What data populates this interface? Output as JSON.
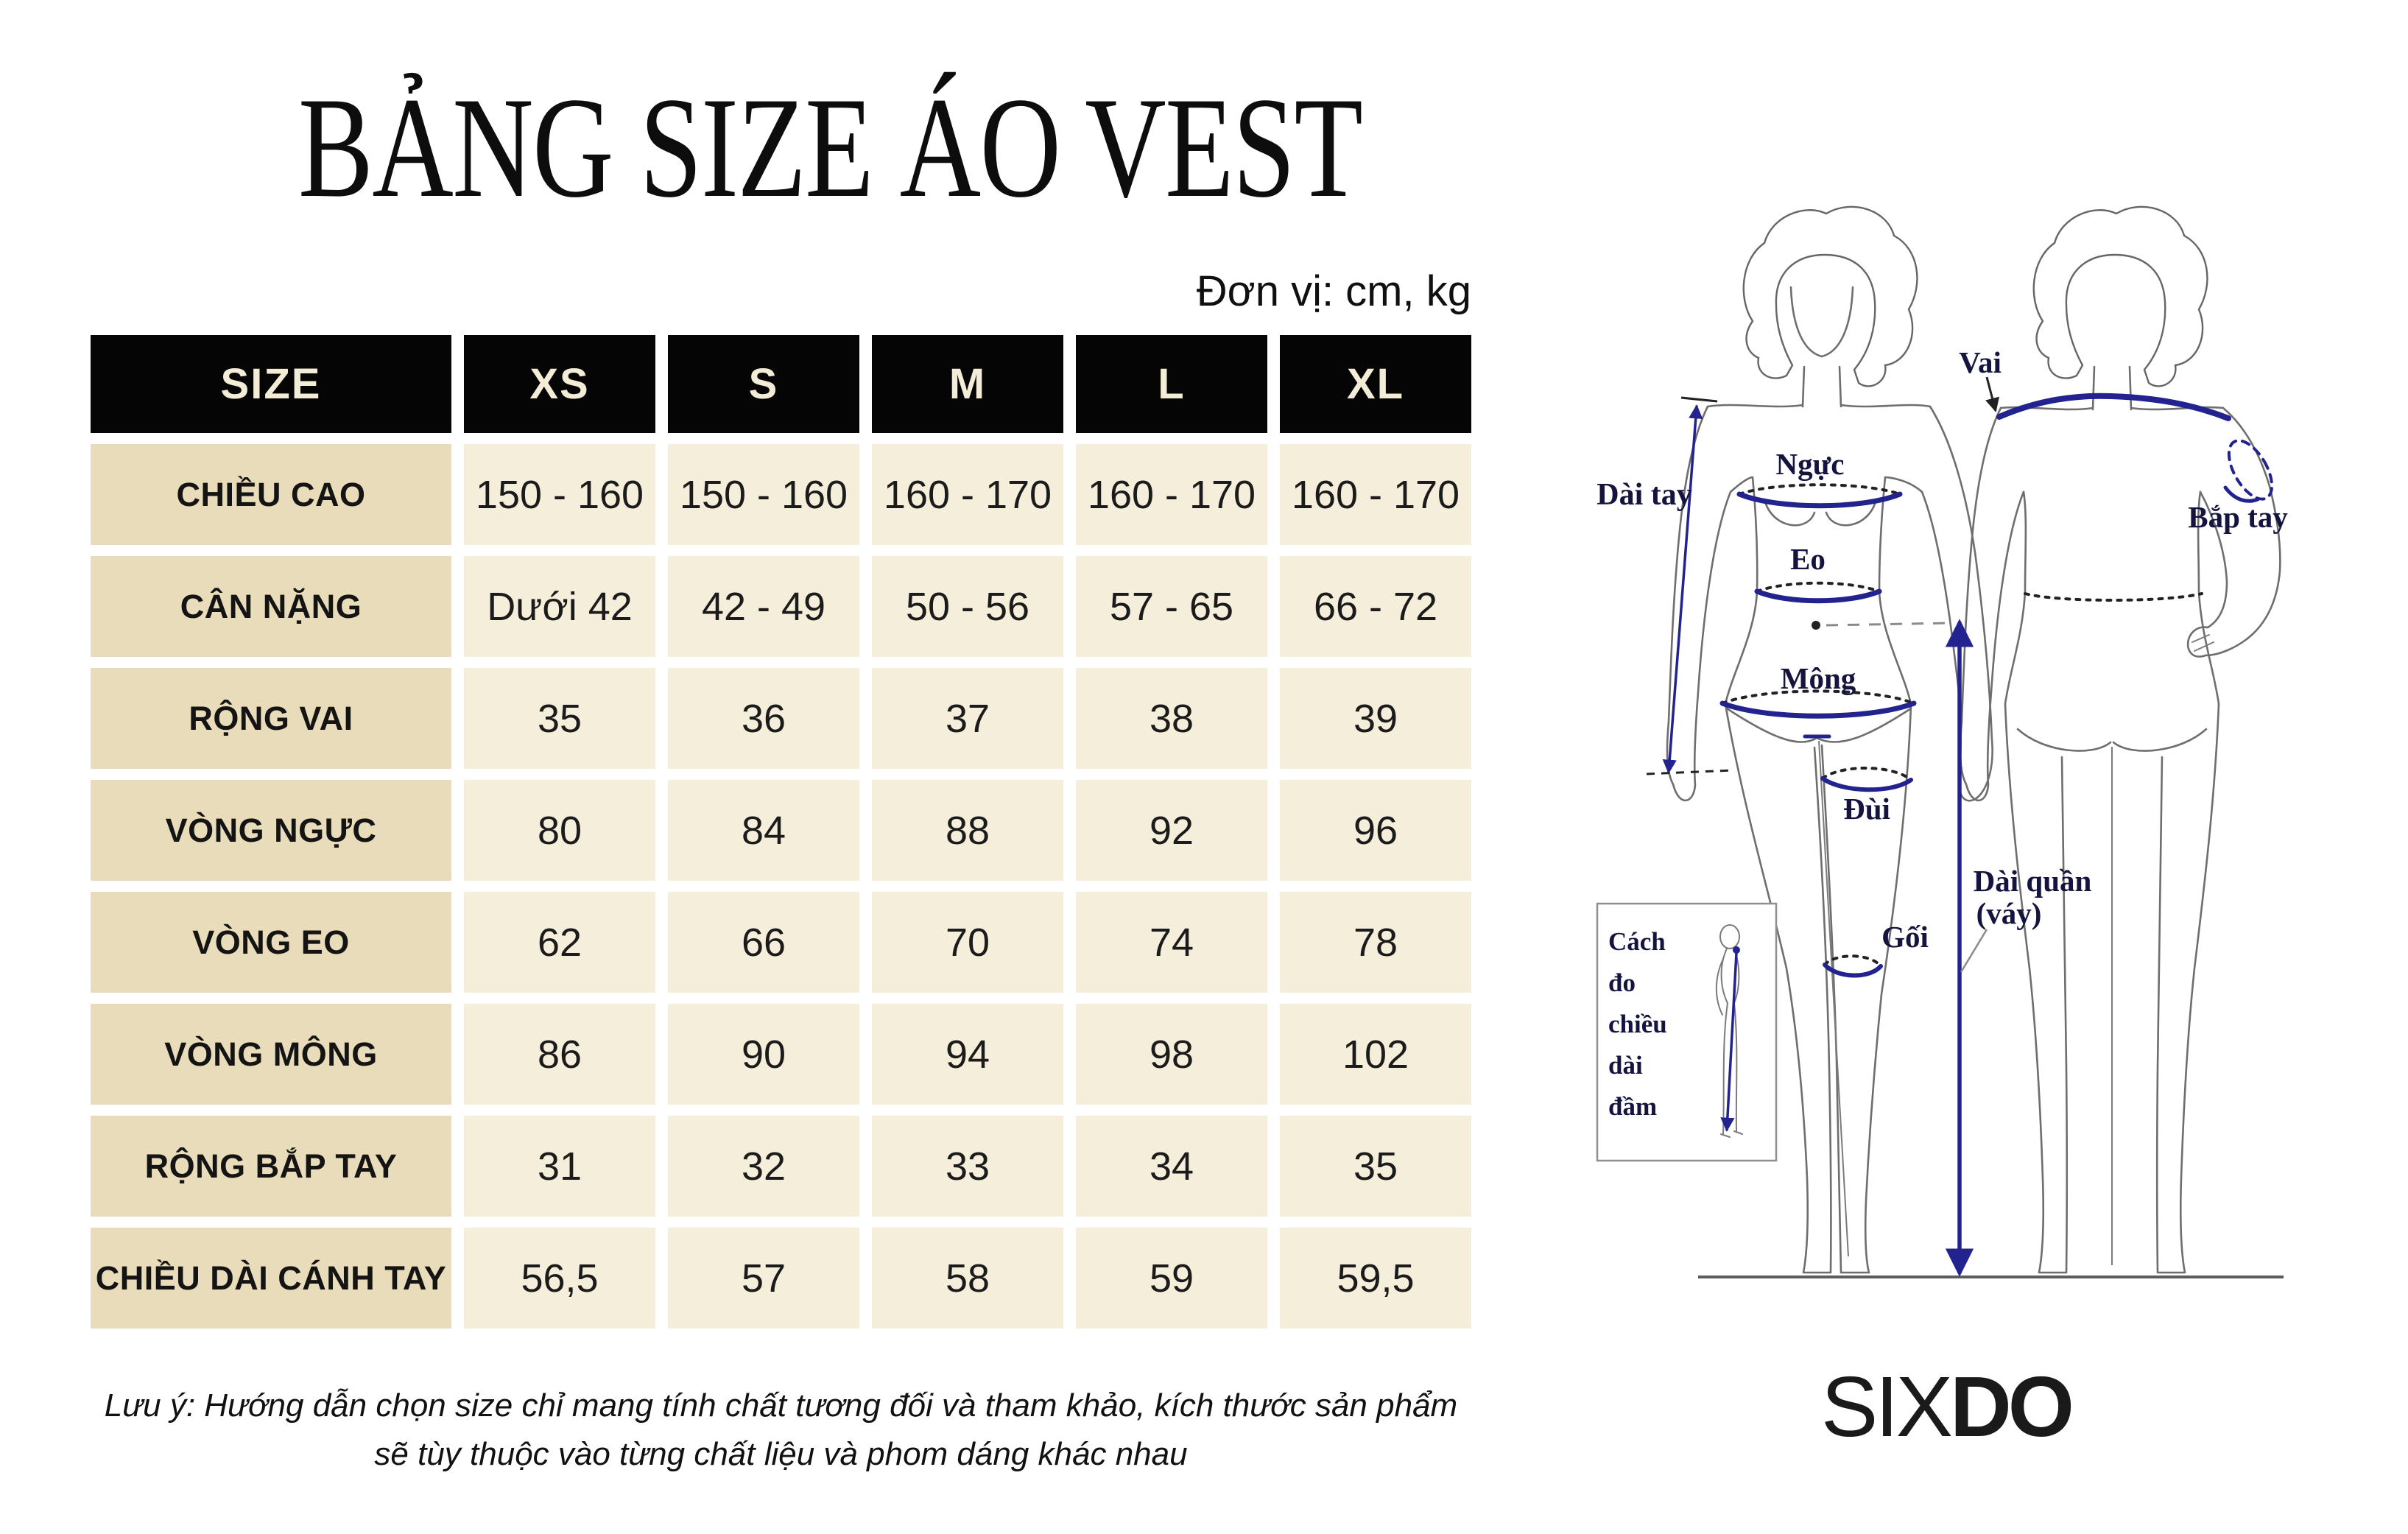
{
  "title": "BẢNG SIZE ÁO VEST",
  "unit_label": "Đơn vị: cm, kg",
  "table": {
    "header": [
      "SIZE",
      "XS",
      "S",
      "M",
      "L",
      "XL"
    ],
    "rows": [
      {
        "label": "CHIỀU CAO",
        "values": [
          "150 - 160",
          "150 - 160",
          "160 - 170",
          "160 - 170",
          "160 - 170"
        ]
      },
      {
        "label": "CÂN NẶNG",
        "values": [
          "Dưới 42",
          "42 - 49",
          "50 - 56",
          "57 - 65",
          "66 - 72"
        ]
      },
      {
        "label": "RỘNG VAI",
        "values": [
          "35",
          "36",
          "37",
          "38",
          "39"
        ]
      },
      {
        "label": "VÒNG NGỰC",
        "values": [
          "80",
          "84",
          "88",
          "92",
          "96"
        ]
      },
      {
        "label": "VÒNG EO",
        "values": [
          "62",
          "66",
          "70",
          "74",
          "78"
        ]
      },
      {
        "label": "VÒNG MÔNG",
        "values": [
          "86",
          "90",
          "94",
          "98",
          "102"
        ]
      },
      {
        "label": "RỘNG BẮP TAY",
        "values": [
          "31",
          "32",
          "33",
          "34",
          "35"
        ]
      },
      {
        "label": "CHIỀU DÀI CÁNH TAY",
        "values": [
          "56,5",
          "57",
          "58",
          "59",
          "59,5"
        ]
      }
    ]
  },
  "note": {
    "line1": "Lưu ý: Hướng dẫn chọn size chỉ mang tính chất tương đối và tham khảo, kích thước sản phẩm",
    "line2": "sẽ tùy thuộc vào từng chất liệu và phom dáng khác nhau"
  },
  "diagram": {
    "labels": {
      "dai_tay": "Dài tay",
      "nguc": "Ngực",
      "eo": "Eo",
      "mong": "Mông",
      "vai": "Vai",
      "bap_tay": "Bắp tay",
      "dui": "Đùi",
      "goi": "Gối",
      "dai_quan": "Dài quần",
      "vay": "(váy)"
    },
    "measure_box_lines": [
      "Cách",
      "đo",
      "chiều",
      "dài",
      "đầm"
    ]
  },
  "brand": {
    "six": "SIX",
    "do": "DO"
  },
  "colors": {
    "header_bg": "#050505",
    "header_text": "#f3ecd7",
    "label_cell_bg": "#e9dcba",
    "data_cell_bg": "#f5eeda",
    "measure_line": "#23238f",
    "diagram_label": "#14143f"
  }
}
